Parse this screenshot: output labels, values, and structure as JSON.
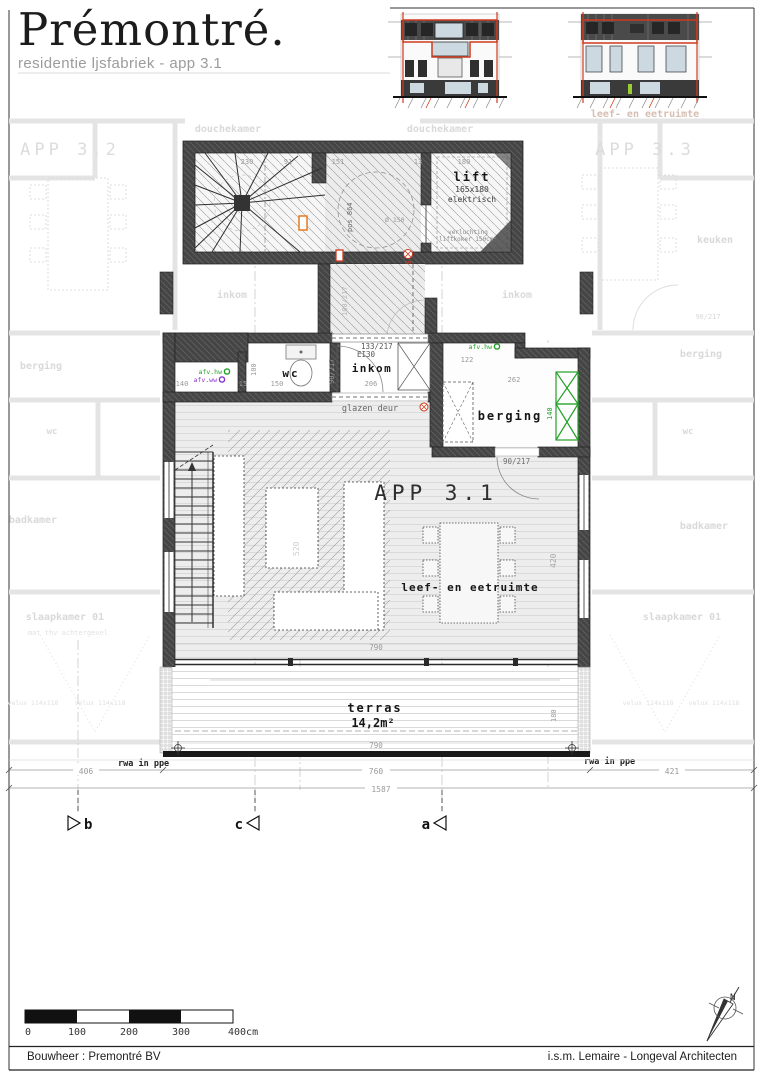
{
  "header": {
    "title": "Prémontré.",
    "subtitle": "residentie ljsfabriek - app 3.1"
  },
  "rooms": {
    "lift": "lift",
    "lift_size": "165x180",
    "lift_type": "elektrisch",
    "lift_note1": "verluchting",
    "lift_note2": "liftkoker 150cm²",
    "wc": "wc",
    "inkom": "inkom",
    "berging": "berging",
    "app": "APP 3.1",
    "living": "leef- en eetruimte",
    "terras": "terras",
    "terras_area": "14,2m²"
  },
  "doors": {
    "entry": "133/217",
    "fire_rating": "EI30",
    "inkom_door": "90/217",
    "corridor_door": "100/217",
    "glazen": "glazen deur"
  },
  "marks": {
    "afv_hw": "afv.hw",
    "afv_ww": "afv.ww",
    "rwa": "rwa in ppe",
    "pos": "pos 864",
    "diam": "Ø 150",
    "rm": "RM",
    "north": "N"
  },
  "dims": {
    "d140": "140",
    "d15": "15",
    "d100": "100",
    "d150": "150",
    "d206": "206",
    "d122": "122",
    "d262": "262",
    "d200": "200",
    "d790": "790",
    "d420": "420",
    "d520": "520",
    "d180": "180",
    "d406": "406",
    "d760": "760",
    "d421": "421",
    "d1587": "1587",
    "top_row": [
      "230",
      "91",
      "151",
      "13",
      "180"
    ]
  },
  "sections": {
    "b": "b",
    "c": "c",
    "a": "a"
  },
  "faded": {
    "app32": "APP 3.2",
    "app33": "APP 3.3",
    "douche": "douchekamer",
    "inkom": "inkom",
    "keuken": "keuken",
    "berging": "berging",
    "badkamer": "badkamer",
    "wc": "wc",
    "slaapkamer": "slaapkamer 01",
    "velux": "velux 114x118",
    "mat": "mat thv achtergevel",
    "living_above": "leef- en eetruimte",
    "door": "90/217"
  },
  "scalebar": {
    "labels": [
      "0",
      "100",
      "200",
      "300",
      "400cm"
    ]
  },
  "footer": {
    "left": "Bouwheer : Premontré BV",
    "right": "i.s.m. Lemaire - Longeval Architecten"
  },
  "colors": {
    "wall": "#414141",
    "accent_red": "#cf3a1e",
    "accent_orange": "#e6791f",
    "accent_green": "#23a126",
    "accent_purple": "#8833cc"
  }
}
